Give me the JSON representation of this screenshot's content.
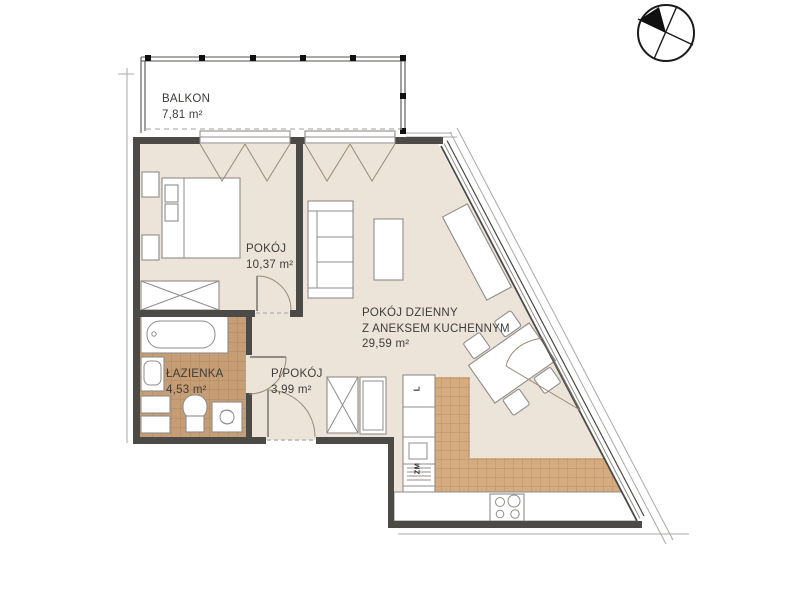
{
  "plan": {
    "rooms": [
      {
        "id": "balkon",
        "name": "BALKON",
        "area": "7,81 m²"
      },
      {
        "id": "pokoj",
        "name": "POKÓJ",
        "area": "10,37 m²"
      },
      {
        "id": "pokoj-dzienny",
        "name": "POKÓJ DZIENNY",
        "name2": "Z ANEKSEM KUCHENNYM",
        "area": "29,59 m²"
      },
      {
        "id": "lazienka",
        "name": "ŁAZIENKA",
        "area": "4,53 m²"
      },
      {
        "id": "przedpokoj",
        "name": "P/POKÓJ",
        "area": "3,99 m²"
      }
    ],
    "appliances": {
      "fridge": "L",
      "dishwasher": "ZM"
    },
    "colors": {
      "floor": "#ece3d9",
      "bath_tile": "#c69e76",
      "bath_tile_line": "#b0875e",
      "kitchen_tile": "#d5ab80",
      "kitchen_tile_line": "#bc9168",
      "wall": "#4b4a47",
      "line": "#8f8d89",
      "swing": "#9b8a76",
      "text": "#3e3c39"
    }
  }
}
